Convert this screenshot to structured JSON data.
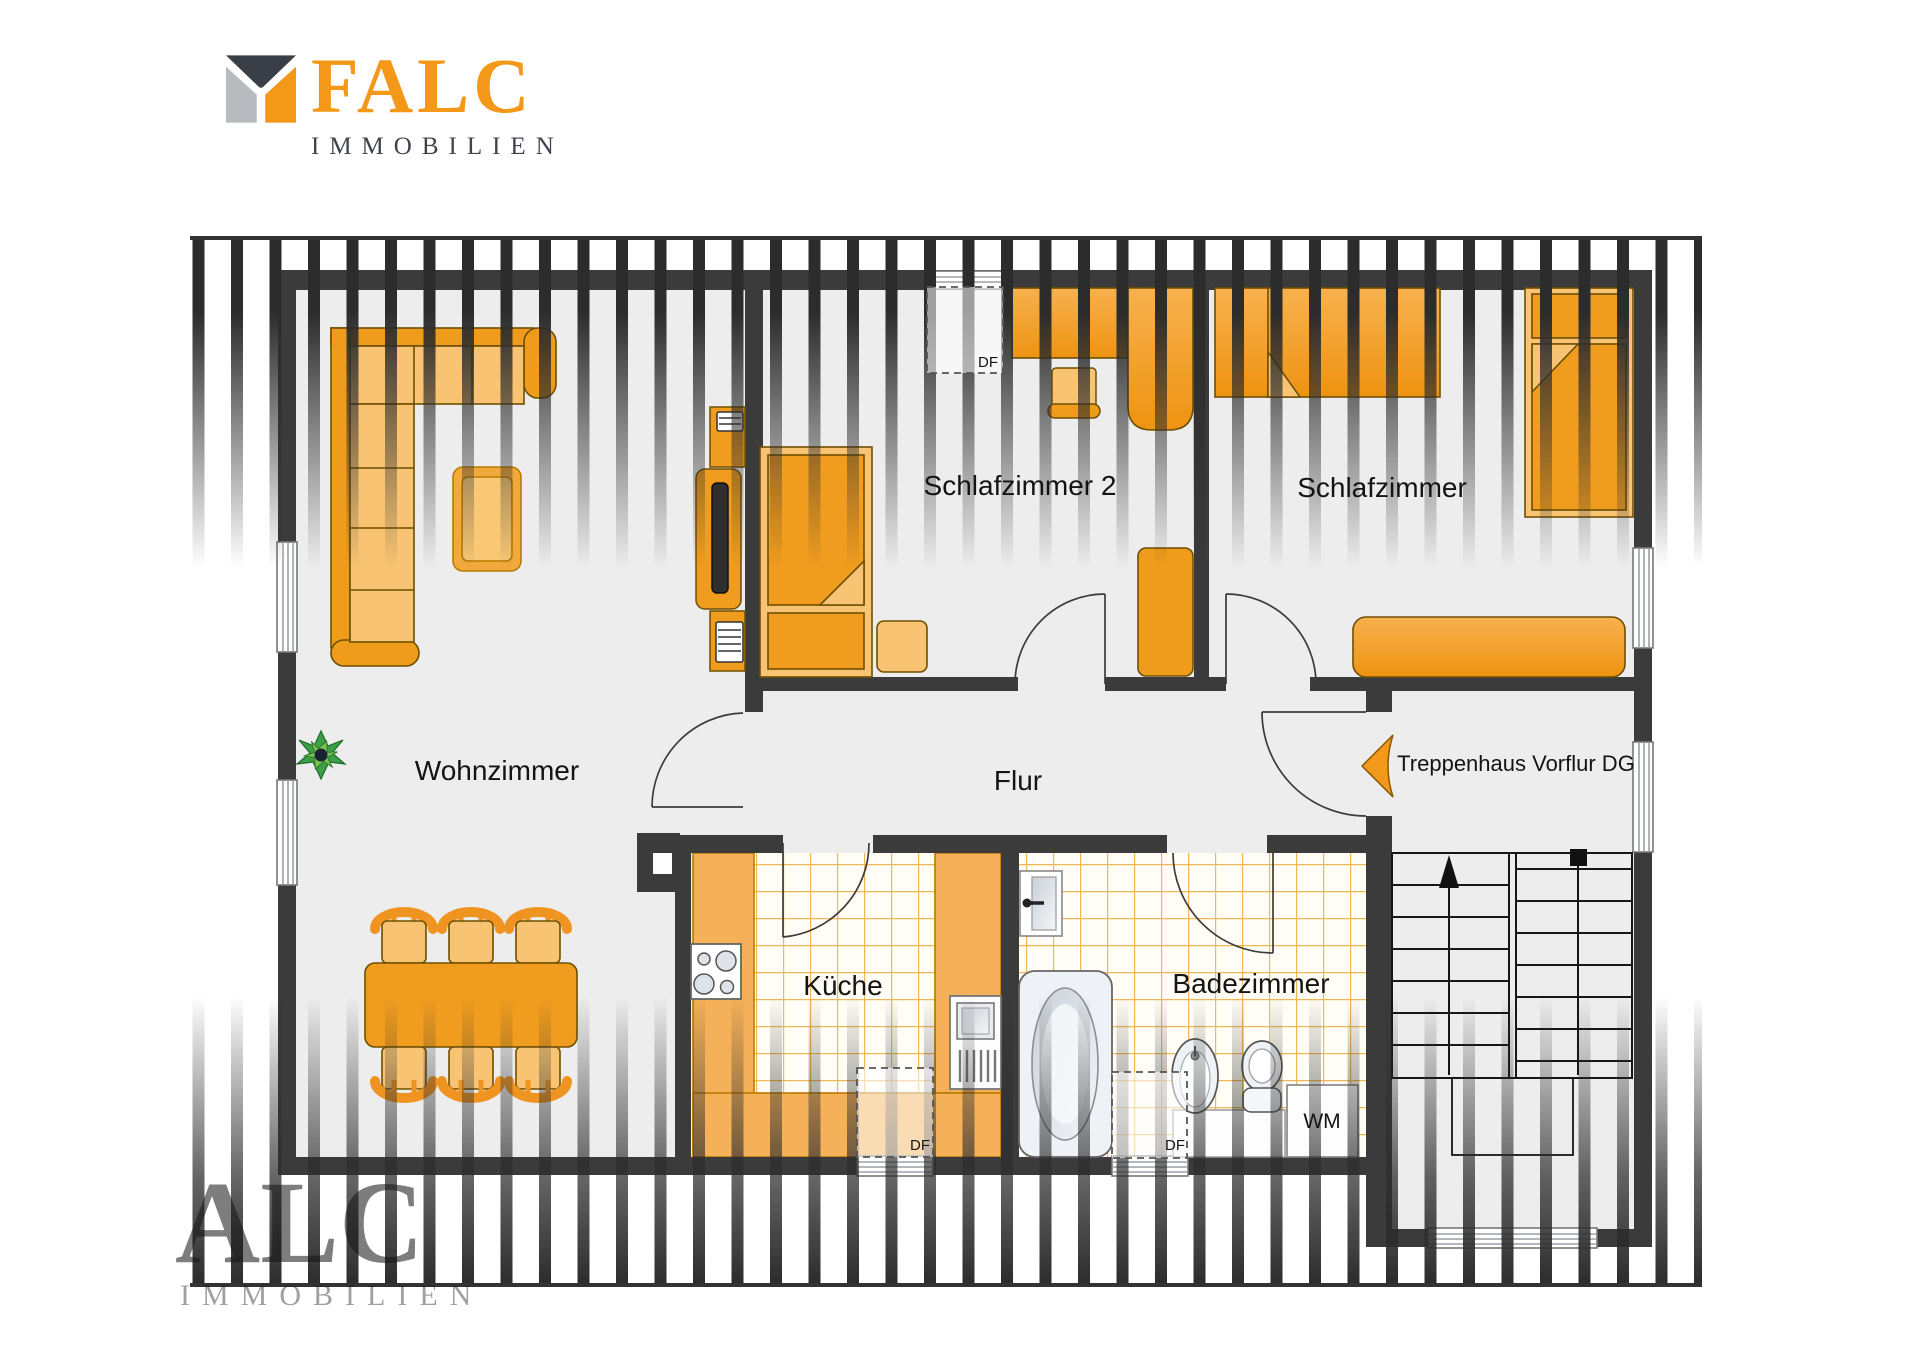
{
  "logo": {
    "brand": "FALC",
    "subtitle": "IMMOBILIEN"
  },
  "watermark": {
    "text": "ALC",
    "subtext": "IMMOBILIEN"
  },
  "rooms": {
    "wohnzimmer": {
      "label": "Wohnzimmer"
    },
    "schlafzimmer2": {
      "label": "Schlafzimmer 2"
    },
    "schlafzimmer": {
      "label": "Schlafzimmer"
    },
    "flur": {
      "label": "Flur"
    },
    "treppenhaus": {
      "label": "Treppenhaus Vorflur DG"
    },
    "kueche": {
      "label": "Küche"
    },
    "badezimmer": {
      "label": "Badezimmer"
    }
  },
  "annotations": {
    "roof_window": "DF",
    "washing_machine": "WM"
  },
  "colors": {
    "accent_orange": "#F49819",
    "furniture_mid": "#EF9C1C",
    "furniture_light": "#F8C473",
    "wall": "#3B3B3B",
    "floor": "#EDEDEE",
    "tile_line": "#ECAF45",
    "logo_dark": "#3F444C",
    "logo_gray": "#B8BCC0"
  }
}
